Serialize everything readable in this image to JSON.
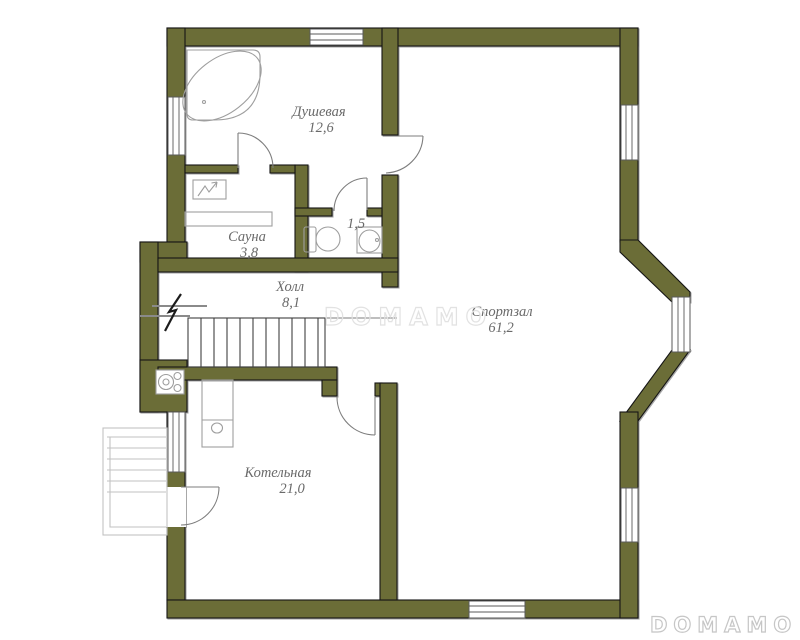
{
  "colors": {
    "wall": "#6b6d37",
    "fixture": "#9e9e9e",
    "label": "#6a6a6a",
    "watermark_center": "#e2e2e2",
    "watermark_corner": "#c6c6c6"
  },
  "rooms": [
    {
      "id": "shower",
      "name": "Душевая",
      "area": "12,6"
    },
    {
      "id": "sauna",
      "name": "Сауна",
      "area": "3,8"
    },
    {
      "id": "wc",
      "name": "",
      "area": "1,5"
    },
    {
      "id": "hall",
      "name": "Холл",
      "area": "8,1"
    },
    {
      "id": "gym",
      "name": "Спортзал",
      "area": "61,2"
    },
    {
      "id": "boiler",
      "name": "Котельная",
      "area": "21,0"
    }
  ],
  "watermark": {
    "center": "DOMAMO",
    "corner": "DOMAMO"
  }
}
